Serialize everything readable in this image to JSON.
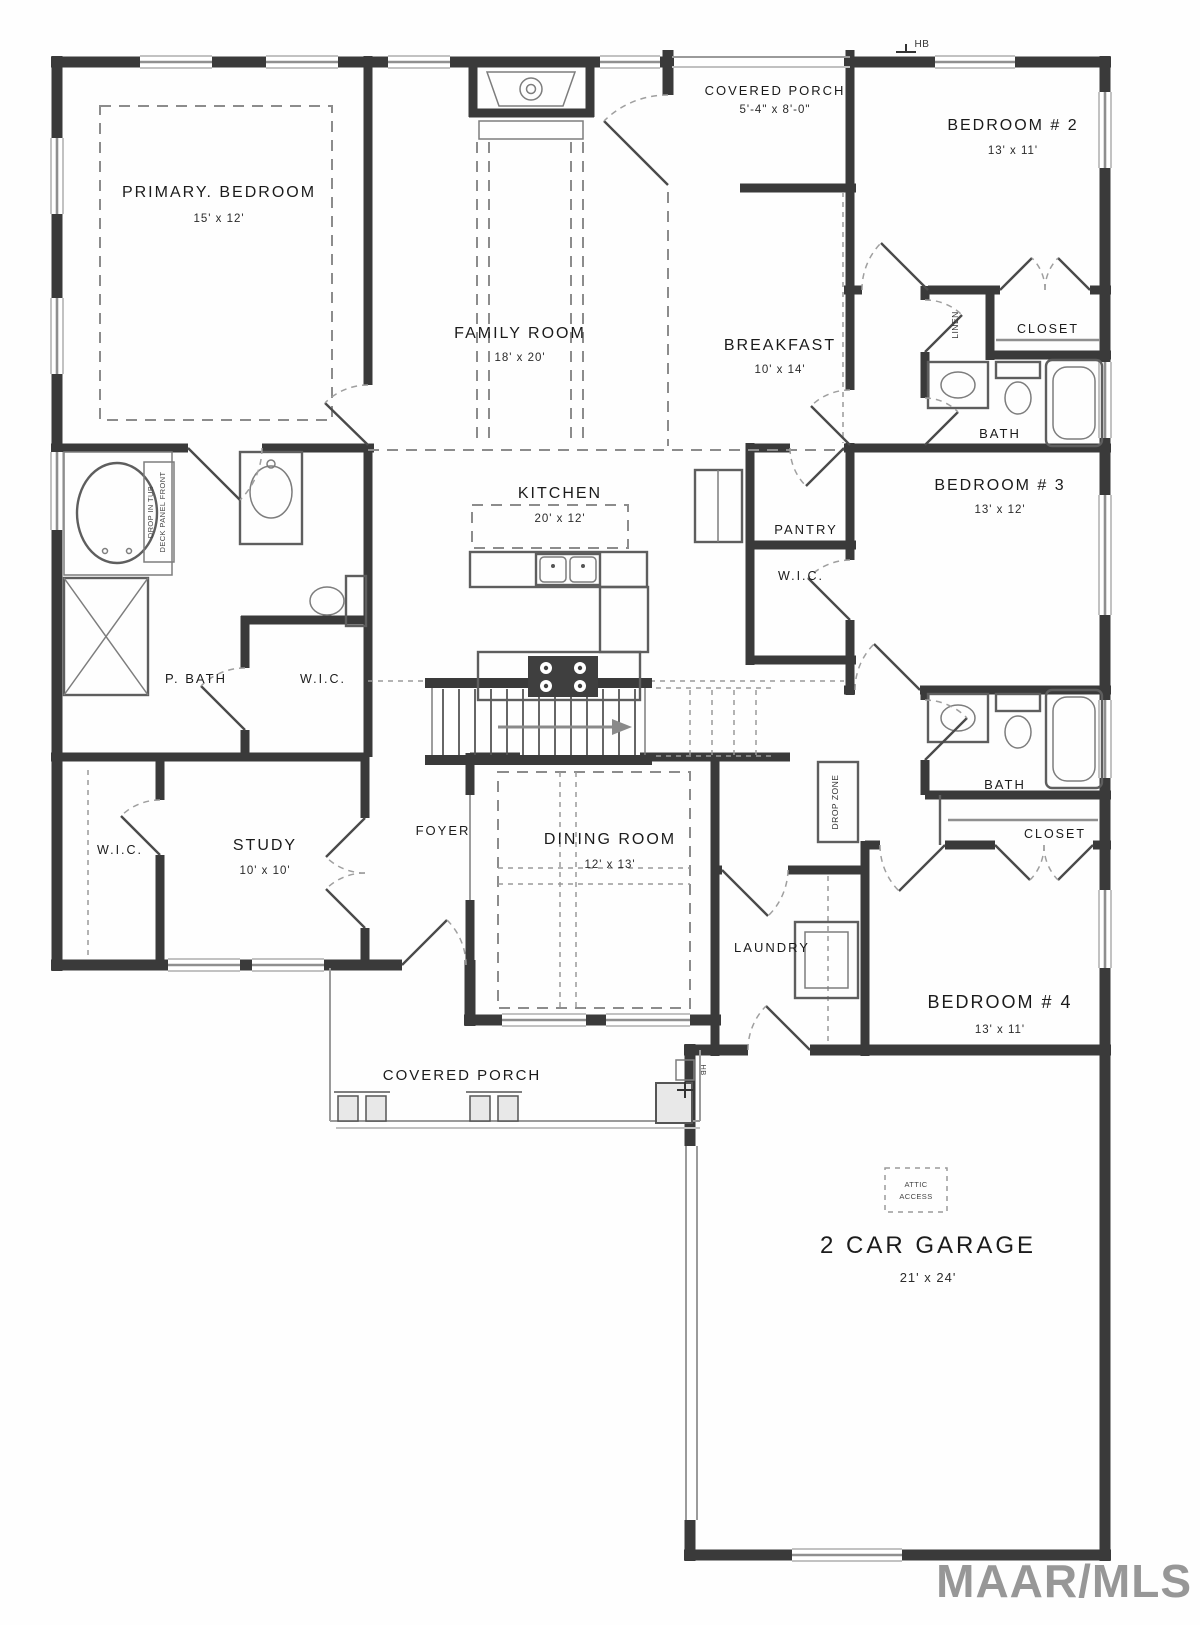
{
  "labels": {
    "primary_name": "PRIMARY. BEDROOM",
    "primary_dims": "15' x 12'",
    "family_name": "FAMILY ROOM",
    "family_dims": "18' x 20'",
    "porch_top_name": "COVERED PORCH",
    "porch_top_dims": "5'-4\" x 8'-0\"",
    "bedroom2_name": "BEDROOM # 2",
    "bedroom2_dims": "13' x 11'",
    "breakfast_name": "BREAKFAST",
    "breakfast_dims": "10' x 14'",
    "linen": "LINEN",
    "closet1": "CLOSET",
    "bath1": "BATH",
    "bedroom3_name": "BEDROOM # 3",
    "bedroom3_dims": "13' x 12'",
    "kitchen_name": "KITCHEN",
    "kitchen_dims": "20' x 12'",
    "pantry": "PANTRY",
    "wic_hall": "W.I.C.",
    "p_bath": "P. BATH",
    "p_wic": "W.I.C.",
    "tub_note_1": "DROP IN TUB",
    "tub_note_2": "DECK PANEL FRONT",
    "wic_left": "W.I.C.",
    "study_name": "STUDY",
    "study_dims": "10' x 10'",
    "foyer": "FOYER",
    "dining_name": "DINING ROOM",
    "dining_dims": "12' x 13'",
    "drop_zone": "DROP ZONE",
    "laundry": "LAUNDRY",
    "bath2": "BATH",
    "closet2": "CLOSET",
    "bedroom4_name": "BEDROOM # 4",
    "bedroom4_dims": "13' x 11'",
    "porch_bottom_name": "COVERED PORCH",
    "garage_name": "2 CAR GARAGE",
    "garage_dims": "21' x 24'",
    "attic_1": "ATTIC",
    "attic_2": "ACCESS",
    "hb_top": "HB",
    "hb_bottom": "HB",
    "watermark": "MAAR/MLS"
  },
  "colors": {
    "wall": "#3a3a3a",
    "fixture_line": "#5e5e5e",
    "dashed_line": "#8c8c8c",
    "text": "#1b1b1b",
    "watermark": "#8f8f8f"
  }
}
